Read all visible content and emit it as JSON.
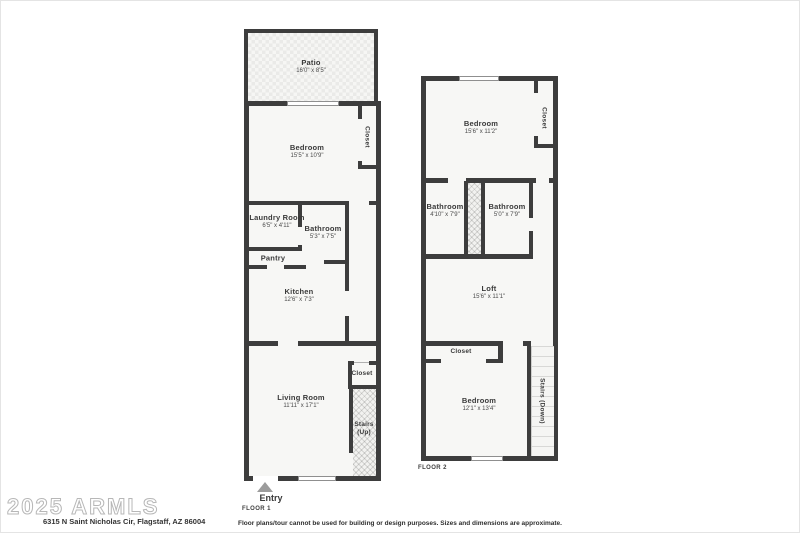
{
  "colors": {
    "wall": "#3d3d3d",
    "room_fill": "#f7f7f5",
    "background": "#ffffff",
    "watermark_gray": "#b7b7b7"
  },
  "floor1": {
    "label": "FLOOR 1",
    "entry": "Entry",
    "patio": {
      "name": "Patio",
      "dims": "16'0\" x 8'5\""
    },
    "bedroom": {
      "name": "Bedroom",
      "dims": "15'5\" x 10'9\""
    },
    "bedroom_closet": {
      "name": "Closet"
    },
    "laundry": {
      "name": "Laundry Room",
      "dims": "6'5\" x 4'11\""
    },
    "bathroom": {
      "name": "Bathroom",
      "dims": "5'3\" x 7'5\""
    },
    "pantry": {
      "name": "Pantry"
    },
    "kitchen": {
      "name": "Kitchen",
      "dims": "12'6\" x 7'3\""
    },
    "living_room": {
      "name": "Living Room",
      "dims": "11'11\" x 17'1\""
    },
    "living_closet": {
      "name": "Closet"
    },
    "stairs": {
      "name": "Stairs",
      "direction": "(Up)"
    }
  },
  "floor2": {
    "label": "FLOOR 2",
    "bedroom_top": {
      "name": "Bedroom",
      "dims": "15'6\" x 11'2\""
    },
    "closet_top": {
      "name": "Closet"
    },
    "bathroom_left": {
      "name": "Bathroom",
      "dims": "4'10\" x 7'9\""
    },
    "bathroom_right": {
      "name": "Bathroom",
      "dims": "5'0\" x 7'9\""
    },
    "loft": {
      "name": "Loft",
      "dims": "15'6\" x 11'1\""
    },
    "closet_bottom": {
      "name": "Closet"
    },
    "bedroom_bottom": {
      "name": "Bedroom",
      "dims": "12'1\" x 13'4\""
    },
    "stairs": {
      "name": "Stairs (Down)"
    }
  },
  "footer": {
    "watermark": "2025 ARMLS",
    "address": "6315 N Saint Nicholas Cir, Flagstaff, AZ 86004",
    "disclaimer": "Floor plans/tour cannot be used for building or design purposes. Sizes and dimensions are approximate."
  }
}
